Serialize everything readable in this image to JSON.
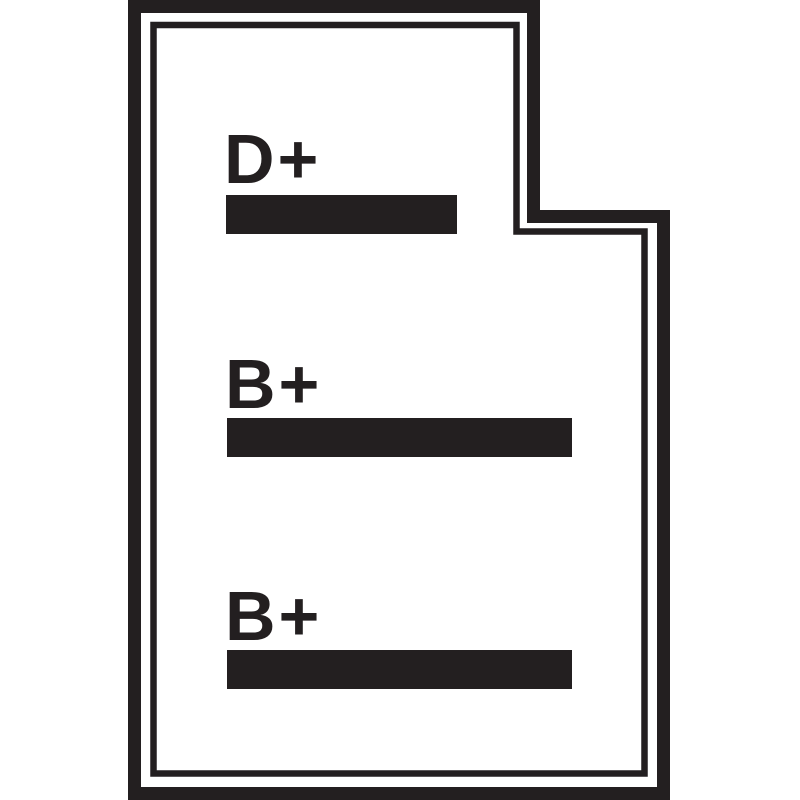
{
  "diagram": {
    "type": "connector-terminal-pinout",
    "colors": {
      "ink": "#231f20",
      "background": "#ffffff"
    },
    "terminals": [
      {
        "label": "D+"
      },
      {
        "label": "B+"
      },
      {
        "label": "B+"
      }
    ]
  }
}
